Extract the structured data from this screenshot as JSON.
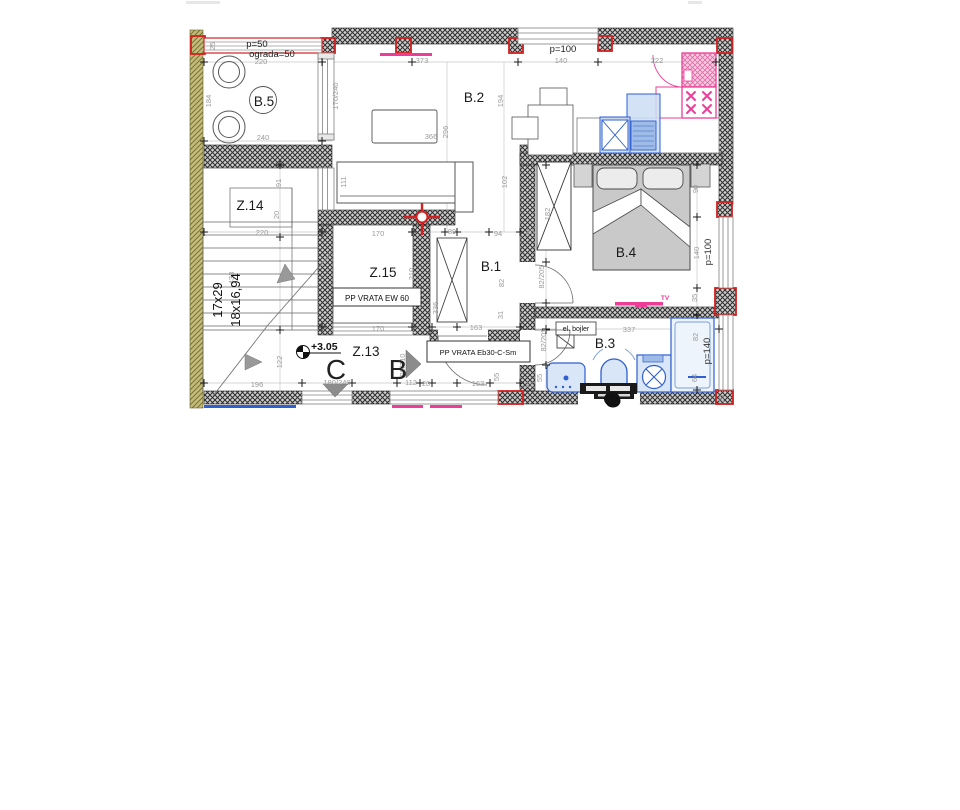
{
  "rooms": {
    "b5": "B.5",
    "b2": "B.2",
    "b4": "B.4",
    "b1": "B.1",
    "b3": "B.3",
    "z13": "Z.13",
    "z14": "Z.14",
    "z15": "Z.15"
  },
  "labels": {
    "parapet_terrace": "p=50",
    "railing": "ograda=50",
    "parapet_top_window": "p=100",
    "parapet_bedroom_window": "p=100",
    "parapet_bath_window": "p=140",
    "elevator_door": "PP VRATA EW 60",
    "entry_fire_door": "PP VRATA Eb30-C-Sm",
    "boiler": "el. bojler",
    "floor_elevation": "+3.05",
    "stair_count": "17x29",
    "stair_step": "18x16,94",
    "tv": "TV",
    "section_c": "C",
    "section_b": "B"
  },
  "dimensions": [
    {
      "t": "220",
      "x": 261,
      "y": 64,
      "v": false
    },
    {
      "t": "373",
      "x": 422,
      "y": 63,
      "v": false
    },
    {
      "t": "140",
      "x": 561,
      "y": 63,
      "v": false
    },
    {
      "t": "222",
      "x": 657,
      "y": 63,
      "v": false
    },
    {
      "t": "25",
      "x": 215,
      "y": 46,
      "v": true
    },
    {
      "t": "184",
      "x": 211,
      "y": 101,
      "v": true
    },
    {
      "t": "240",
      "x": 263,
      "y": 140,
      "v": false
    },
    {
      "t": "170/240",
      "x": 338,
      "y": 96,
      "v": true
    },
    {
      "t": "194",
      "x": 503,
      "y": 101,
      "v": true
    },
    {
      "t": "296",
      "x": 448,
      "y": 132,
      "v": true
    },
    {
      "t": "366",
      "x": 431,
      "y": 139,
      "v": false
    },
    {
      "t": "111",
      "x": 346,
      "y": 182,
      "v": true
    },
    {
      "t": "102",
      "x": 507,
      "y": 182,
      "v": true
    },
    {
      "t": "91",
      "x": 281,
      "y": 183,
      "v": true
    },
    {
      "t": "20",
      "x": 279,
      "y": 215,
      "v": true
    },
    {
      "t": "220",
      "x": 262,
      "y": 235,
      "v": false
    },
    {
      "t": "433",
      "x": 234,
      "y": 278,
      "v": true
    },
    {
      "t": "196",
      "x": 257,
      "y": 387,
      "v": false
    },
    {
      "t": "122",
      "x": 282,
      "y": 362,
      "v": true
    },
    {
      "t": "170",
      "x": 378,
      "y": 236,
      "v": false
    },
    {
      "t": "210",
      "x": 414,
      "y": 274,
      "v": true
    },
    {
      "t": "170",
      "x": 378,
      "y": 331,
      "v": false
    },
    {
      "t": "89",
      "x": 452,
      "y": 234,
      "v": false
    },
    {
      "t": "94",
      "x": 498,
      "y": 236,
      "v": false
    },
    {
      "t": "82",
      "x": 504,
      "y": 283,
      "v": true
    },
    {
      "t": "31",
      "x": 503,
      "y": 315,
      "v": true
    },
    {
      "t": "336",
      "x": 438,
      "y": 308,
      "v": true
    },
    {
      "t": "163",
      "x": 476,
      "y": 330,
      "v": false
    },
    {
      "t": "182",
      "x": 550,
      "y": 214,
      "v": true
    },
    {
      "t": "25",
      "x": 530,
      "y": 234,
      "v": false
    },
    {
      "t": "82/205",
      "x": 544,
      "y": 277,
      "v": true
    },
    {
      "t": "90",
      "x": 698,
      "y": 189,
      "v": true
    },
    {
      "t": "140",
      "x": 699,
      "y": 253,
      "v": true
    },
    {
      "t": "35",
      "x": 697,
      "y": 298,
      "v": true
    },
    {
      "t": "180/240",
      "x": 337,
      "y": 385,
      "v": false
    },
    {
      "t": "112",
      "x": 411,
      "y": 385,
      "v": false
    },
    {
      "t": "20",
      "x": 426,
      "y": 386,
      "v": false
    },
    {
      "t": "163",
      "x": 478,
      "y": 386,
      "v": false
    },
    {
      "t": "90/210",
      "x": 405,
      "y": 365,
      "v": true
    },
    {
      "t": "55",
      "x": 499,
      "y": 377,
      "v": true
    },
    {
      "t": "25",
      "x": 530,
      "y": 387,
      "v": false
    },
    {
      "t": "82/205",
      "x": 546,
      "y": 340,
      "v": true
    },
    {
      "t": "55",
      "x": 542,
      "y": 378,
      "v": true
    },
    {
      "t": "337",
      "x": 629,
      "y": 332,
      "v": false
    },
    {
      "t": "82",
      "x": 698,
      "y": 337,
      "v": true
    },
    {
      "t": "64",
      "x": 697,
      "y": 378,
      "v": true
    },
    {
      "t": "20",
      "x": 724,
      "y": 399,
      "v": true
    }
  ],
  "colors": {
    "wall_hatch": "#2e2e2e",
    "insulation": "#c3bc7d",
    "accent_red": "#d42020",
    "accent_pink": "#ee3d96",
    "fixture_blue": "#2f5fd0",
    "fixture_blue_fill": "#d9e6f7",
    "furniture_gray": "#c9c9c9",
    "dimension_text": "#9a9a9a"
  }
}
